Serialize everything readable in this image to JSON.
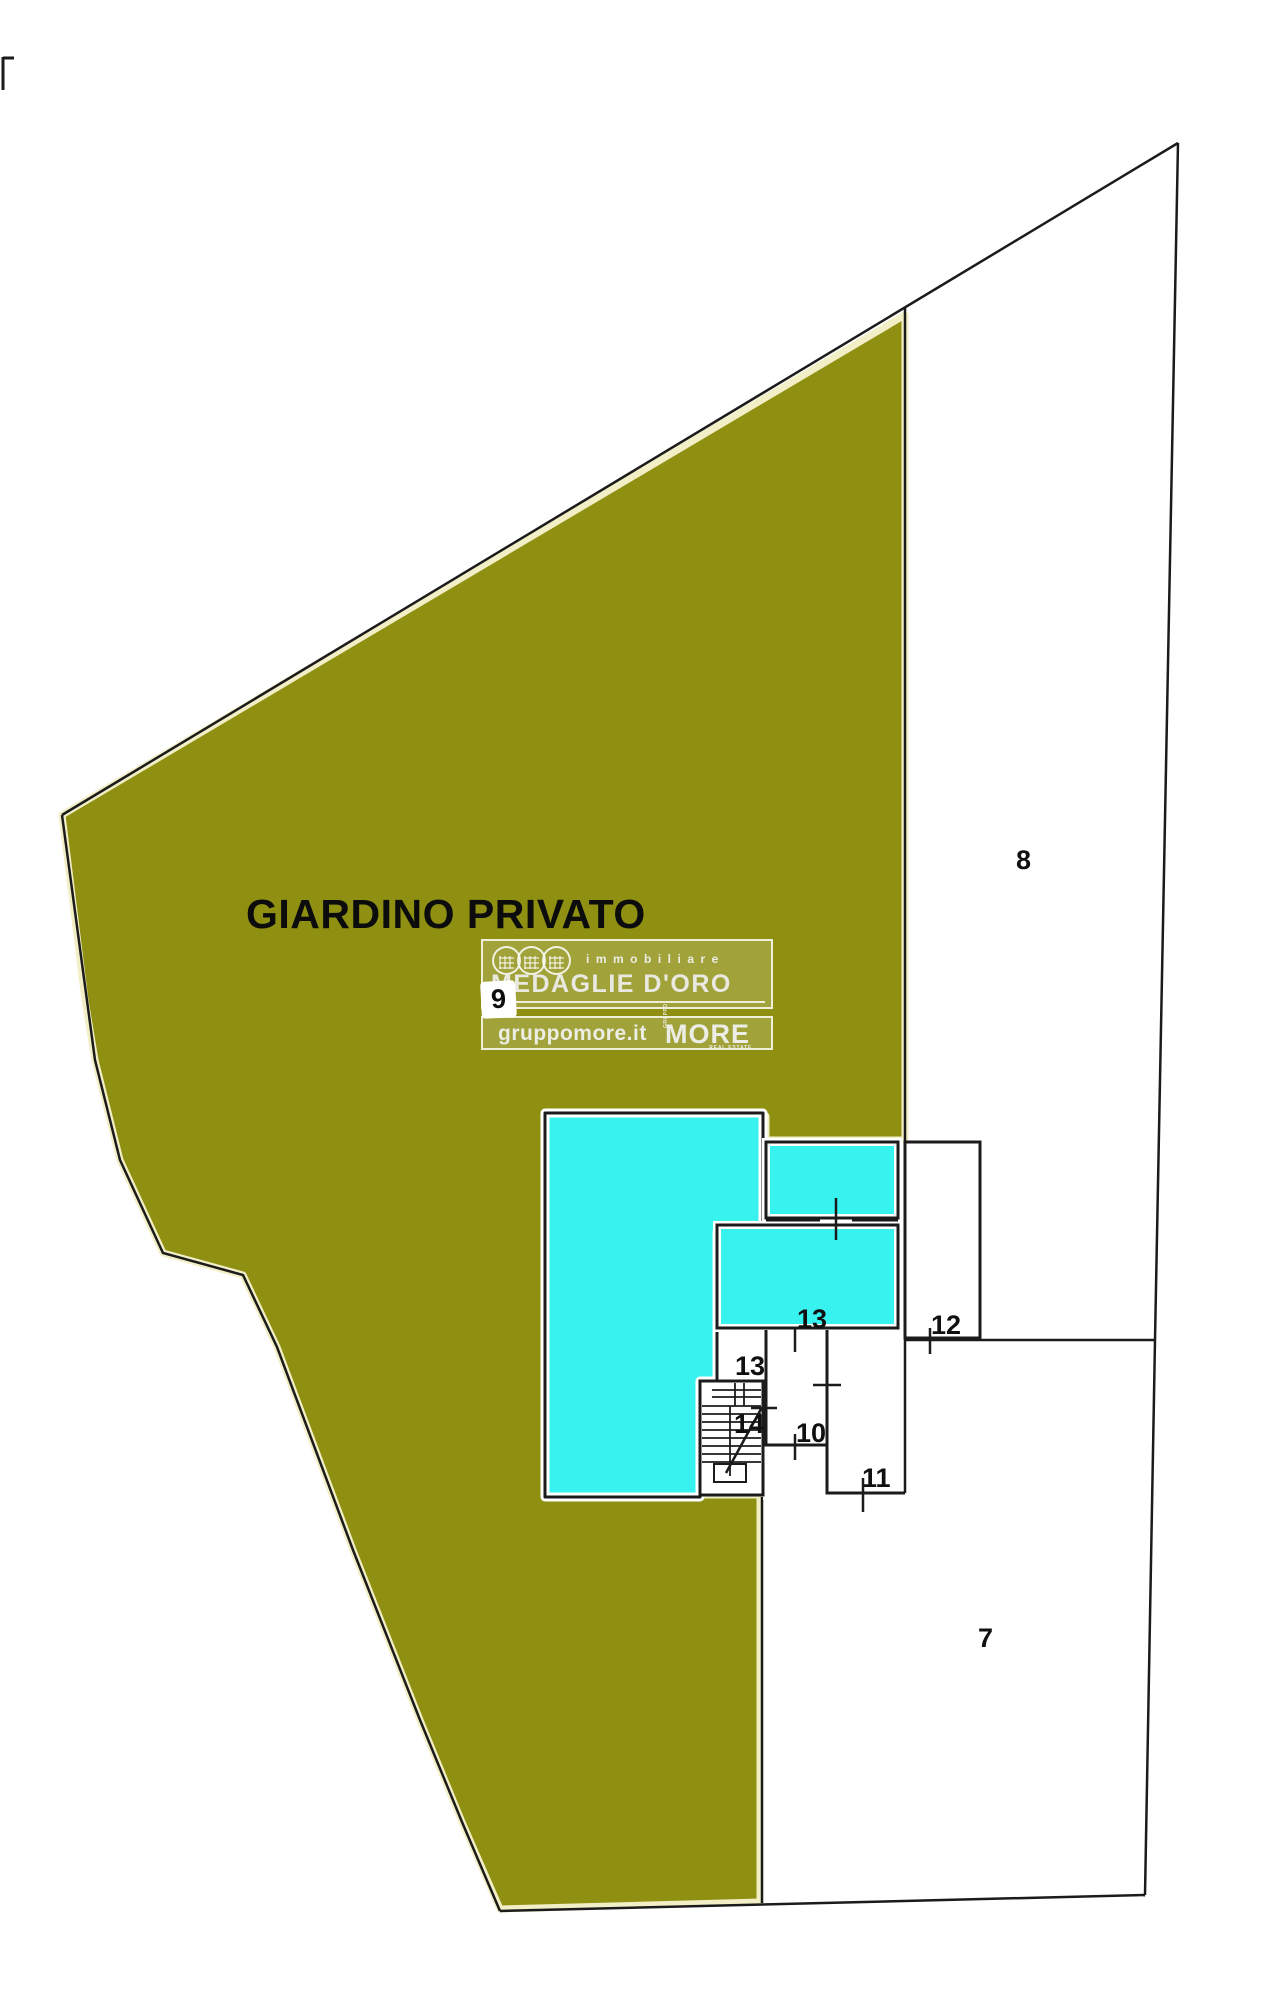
{
  "plan": {
    "type": "cadastral-floor-plan",
    "garden_label": "GIARDINO PRIVATO",
    "garden_color": "#8f9012",
    "garden_fringe_color": "#f2eec6",
    "room_fill_color": "#38f2f0",
    "line_color": "#1b1b1b",
    "background_color": "#ffffff",
    "labels": {
      "l7": "7",
      "l8": "8",
      "l9": "9",
      "l10": "10",
      "l11": "11",
      "l12": "12",
      "l13a": "13",
      "l13b": "13",
      "l14": "14"
    }
  },
  "watermark": {
    "immobiliare": "immobiliare",
    "brand": "MEDAGLIE D'ORO",
    "website": "gruppomore.it",
    "gruppo": "GRUPPO",
    "more": "MORE",
    "real_estate": "REAL ESTATE"
  }
}
